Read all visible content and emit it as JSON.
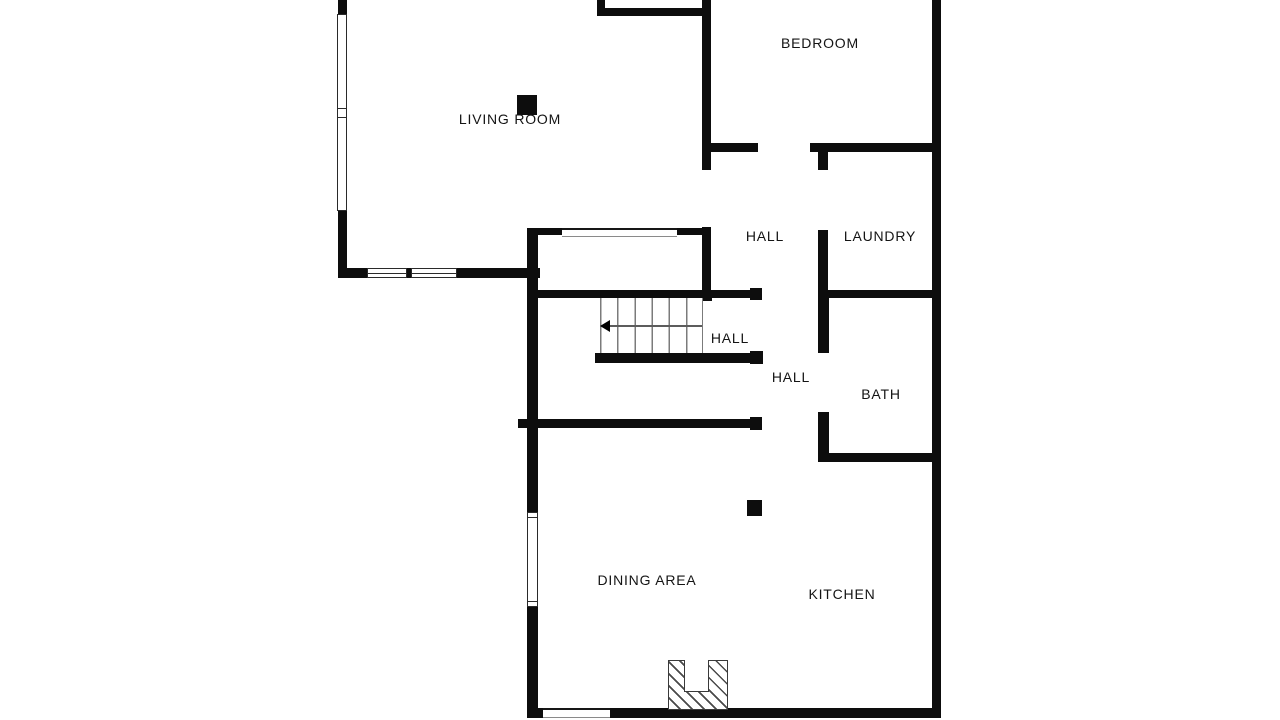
{
  "floorplan": {
    "title": "Residential floor plan",
    "rooms": [
      {
        "id": "living-room",
        "label": "LIVING ROOM"
      },
      {
        "id": "bedroom",
        "label": "BEDROOM"
      },
      {
        "id": "hall-upper",
        "label": "HALL"
      },
      {
        "id": "laundry",
        "label": "LAUNDRY"
      },
      {
        "id": "hall-stairs",
        "label": "HALL"
      },
      {
        "id": "hall-lower",
        "label": "HALL"
      },
      {
        "id": "bath",
        "label": "BATH"
      },
      {
        "id": "dining-area",
        "label": "DINING AREA"
      },
      {
        "id": "kitchen",
        "label": "KITCHEN"
      }
    ],
    "stairs": {
      "direction": "left",
      "treads": 6
    },
    "colors": {
      "wall": "#0d0d0d",
      "background": "#ffffff",
      "stair_lines": "#7b7b7b",
      "hatch": "#4a4a4a"
    }
  }
}
